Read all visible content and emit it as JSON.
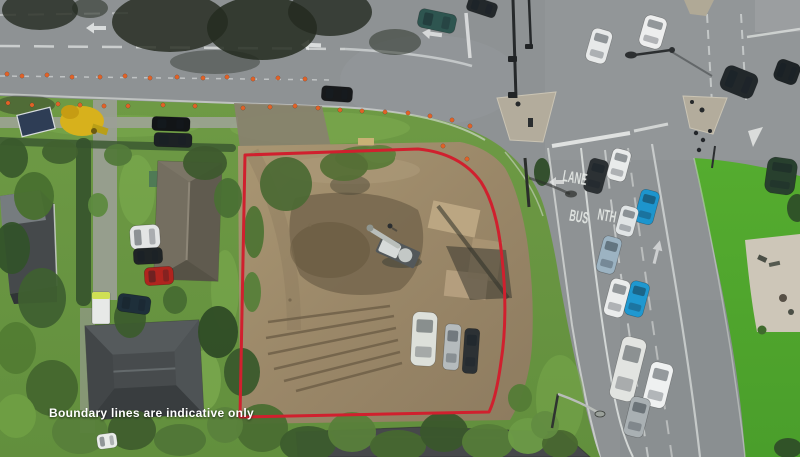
{
  "caption": {
    "text": "Boundary lines are indicative only"
  },
  "road_markings_text": {
    "lane": "LANE",
    "bus": "BUS",
    "nth": "NTH"
  },
  "colors": {
    "boundary_red": "#d0202e",
    "asphalt": "#8e9294",
    "grass_berm": "#6e9a45",
    "grass_corner": "#55ac2f",
    "dirt": "#9a8768",
    "cone_orange": "#e06228",
    "caption_white": "#ffffff"
  },
  "scene": {
    "cones": [
      [
        7,
        74
      ],
      [
        22,
        76
      ],
      [
        47,
        75
      ],
      [
        72,
        77
      ],
      [
        100,
        77
      ],
      [
        125,
        76
      ],
      [
        150,
        78
      ],
      [
        177,
        77
      ],
      [
        203,
        78
      ],
      [
        227,
        77
      ],
      [
        253,
        79
      ],
      [
        278,
        78
      ],
      [
        305,
        79
      ],
      [
        8,
        103
      ],
      [
        32,
        105
      ],
      [
        58,
        104
      ],
      [
        80,
        105
      ],
      [
        104,
        106
      ],
      [
        128,
        106
      ],
      [
        163,
        105
      ],
      [
        195,
        106
      ],
      [
        243,
        108
      ],
      [
        270,
        107
      ],
      [
        295,
        106
      ],
      [
        318,
        108
      ],
      [
        340,
        110
      ],
      [
        362,
        111
      ],
      [
        385,
        112
      ],
      [
        408,
        113
      ],
      [
        430,
        116
      ],
      [
        443,
        146
      ],
      [
        452,
        120
      ],
      [
        467,
        159
      ],
      [
        470,
        126
      ]
    ],
    "trees": [
      [
        12,
        158,
        16,
        20,
        "#3a5a2c"
      ],
      [
        34,
        196,
        20,
        24,
        "#49702f"
      ],
      [
        12,
        248,
        18,
        26,
        "#33522a"
      ],
      [
        42,
        298,
        24,
        30,
        "#3f6030"
      ],
      [
        16,
        348,
        20,
        26,
        "#527c33"
      ],
      [
        52,
        388,
        26,
        28,
        "#45672e"
      ],
      [
        16,
        416,
        20,
        22,
        "#6f9f43"
      ],
      [
        80,
        432,
        28,
        22,
        "#57803a"
      ],
      [
        130,
        318,
        16,
        20,
        "#3c5c2d"
      ],
      [
        175,
        300,
        12,
        14,
        "#476c31"
      ],
      [
        205,
        163,
        22,
        17,
        "#3e5a2e"
      ],
      [
        228,
        198,
        14,
        20,
        "#4a7034"
      ],
      [
        218,
        332,
        20,
        26,
        "#2f4c26"
      ],
      [
        242,
        372,
        18,
        24,
        "#3a5a2c"
      ],
      [
        118,
        155,
        14,
        11,
        "#52793a"
      ],
      [
        98,
        205,
        10,
        12,
        "#5d8a3f"
      ],
      [
        365,
        158,
        30,
        12,
        "#5a7a38"
      ],
      [
        286,
        184,
        26,
        27,
        "#4d6a35"
      ],
      [
        344,
        166,
        24,
        15,
        "#556f36"
      ],
      [
        380,
        154,
        16,
        9,
        "#60803d"
      ],
      [
        254,
        232,
        10,
        26,
        "#4f7434"
      ],
      [
        252,
        292,
        9,
        20,
        "#57803a"
      ],
      [
        262,
        428,
        26,
        24,
        "#4a6e31"
      ],
      [
        308,
        444,
        28,
        18,
        "#3c5c2d"
      ],
      [
        352,
        432,
        24,
        20,
        "#587f3a"
      ],
      [
        398,
        446,
        28,
        16,
        "#47682f"
      ],
      [
        444,
        432,
        24,
        20,
        "#3a572b"
      ],
      [
        488,
        442,
        26,
        18,
        "#557c38"
      ],
      [
        528,
        436,
        20,
        18,
        "#6d9c46"
      ],
      [
        560,
        444,
        18,
        14,
        "#49682f"
      ],
      [
        520,
        398,
        12,
        14,
        "#547c36"
      ],
      [
        545,
        425,
        14,
        14,
        "#628c41"
      ],
      [
        132,
        430,
        24,
        20,
        "#3f5e2d"
      ],
      [
        180,
        440,
        26,
        16,
        "#507637"
      ],
      [
        225,
        425,
        18,
        18,
        "#5a823c"
      ],
      [
        788,
        448,
        14,
        10,
        "#2f4f28"
      ],
      [
        542,
        172,
        8,
        14,
        "#2f4d28"
      ],
      [
        60,
        152,
        18,
        12,
        "#41612f"
      ]
    ],
    "vehicles": [
      {
        "x": 437,
        "y": 21,
        "w": 38,
        "h": 19,
        "r": 12,
        "c": "#2e5550"
      },
      {
        "x": 482,
        "y": 7,
        "w": 30,
        "h": 15,
        "r": 18,
        "c": "#23282b"
      },
      {
        "x": 337,
        "y": 94,
        "w": 31,
        "h": 15,
        "r": 4,
        "c": "#17191b"
      },
      {
        "x": 171,
        "y": 124,
        "w": 38,
        "h": 14,
        "r": 2,
        "c": "#121517"
      },
      {
        "x": 173,
        "y": 140,
        "w": 38,
        "h": 14,
        "r": 2,
        "c": "#1c2124"
      },
      {
        "x": 599,
        "y": 46,
        "w": 21,
        "h": 34,
        "r": 16,
        "c": "#e7e9e9"
      },
      {
        "x": 653,
        "y": 32,
        "w": 23,
        "h": 32,
        "r": 16,
        "c": "#edeeee"
      },
      {
        "x": 739,
        "y": 82,
        "w": 35,
        "h": 26,
        "r": 22,
        "c": "#22282b"
      },
      {
        "x": 787,
        "y": 72,
        "w": 24,
        "h": 22,
        "r": 20,
        "c": "#1e2427"
      },
      {
        "x": 596,
        "y": 176,
        "w": 19,
        "h": 34,
        "r": 15,
        "c": "#2c3134"
      },
      {
        "x": 619,
        "y": 165,
        "w": 19,
        "h": 32,
        "r": 15,
        "c": "#e9ebeb"
      },
      {
        "x": 647,
        "y": 207,
        "w": 19,
        "h": 34,
        "r": 15,
        "c": "#1d95cd"
      },
      {
        "x": 627,
        "y": 221,
        "w": 18,
        "h": 30,
        "r": 15,
        "c": "#e0e4e5"
      },
      {
        "x": 609,
        "y": 255,
        "w": 19,
        "h": 37,
        "r": 15,
        "c": "#9cb3c2"
      },
      {
        "x": 617,
        "y": 298,
        "w": 20,
        "h": 38,
        "r": 15,
        "c": "#eaecec"
      },
      {
        "x": 637,
        "y": 299,
        "w": 19,
        "h": 35,
        "r": 15,
        "c": "#1f98d0"
      },
      {
        "x": 628,
        "y": 369,
        "w": 25,
        "h": 64,
        "r": 14,
        "c": "#e2e4e1"
      },
      {
        "x": 658,
        "y": 385,
        "w": 23,
        "h": 45,
        "r": 14,
        "c": "#eff1f1"
      },
      {
        "x": 637,
        "y": 417,
        "w": 20,
        "h": 40,
        "r": 14,
        "c": "#a9b0b3"
      },
      {
        "x": 781,
        "y": 176,
        "w": 30,
        "h": 36,
        "r": 8,
        "c": "#28402e"
      },
      {
        "x": 424,
        "y": 339,
        "w": 25,
        "h": 54,
        "r": 3,
        "c": "#dde0da"
      },
      {
        "x": 452,
        "y": 347,
        "w": 16,
        "h": 46,
        "r": 4,
        "c": "#b5bbbd"
      },
      {
        "x": 471,
        "y": 351,
        "w": 15,
        "h": 45,
        "r": 4,
        "c": "#2c3134"
      },
      {
        "x": 145,
        "y": 237,
        "w": 30,
        "h": 24,
        "r": -4,
        "c": "#e3e5e5"
      },
      {
        "x": 148,
        "y": 256,
        "w": 29,
        "h": 16,
        "r": -3,
        "c": "#1f2426"
      },
      {
        "x": 159,
        "y": 276,
        "w": 29,
        "h": 18,
        "r": -4,
        "c": "#b0241e"
      },
      {
        "x": 134,
        "y": 304,
        "w": 33,
        "h": 18,
        "r": 8,
        "c": "#1e2f3a"
      },
      {
        "x": 107,
        "y": 441,
        "w": 20,
        "h": 15,
        "r": -8,
        "c": "#e9ece9"
      }
    ]
  }
}
